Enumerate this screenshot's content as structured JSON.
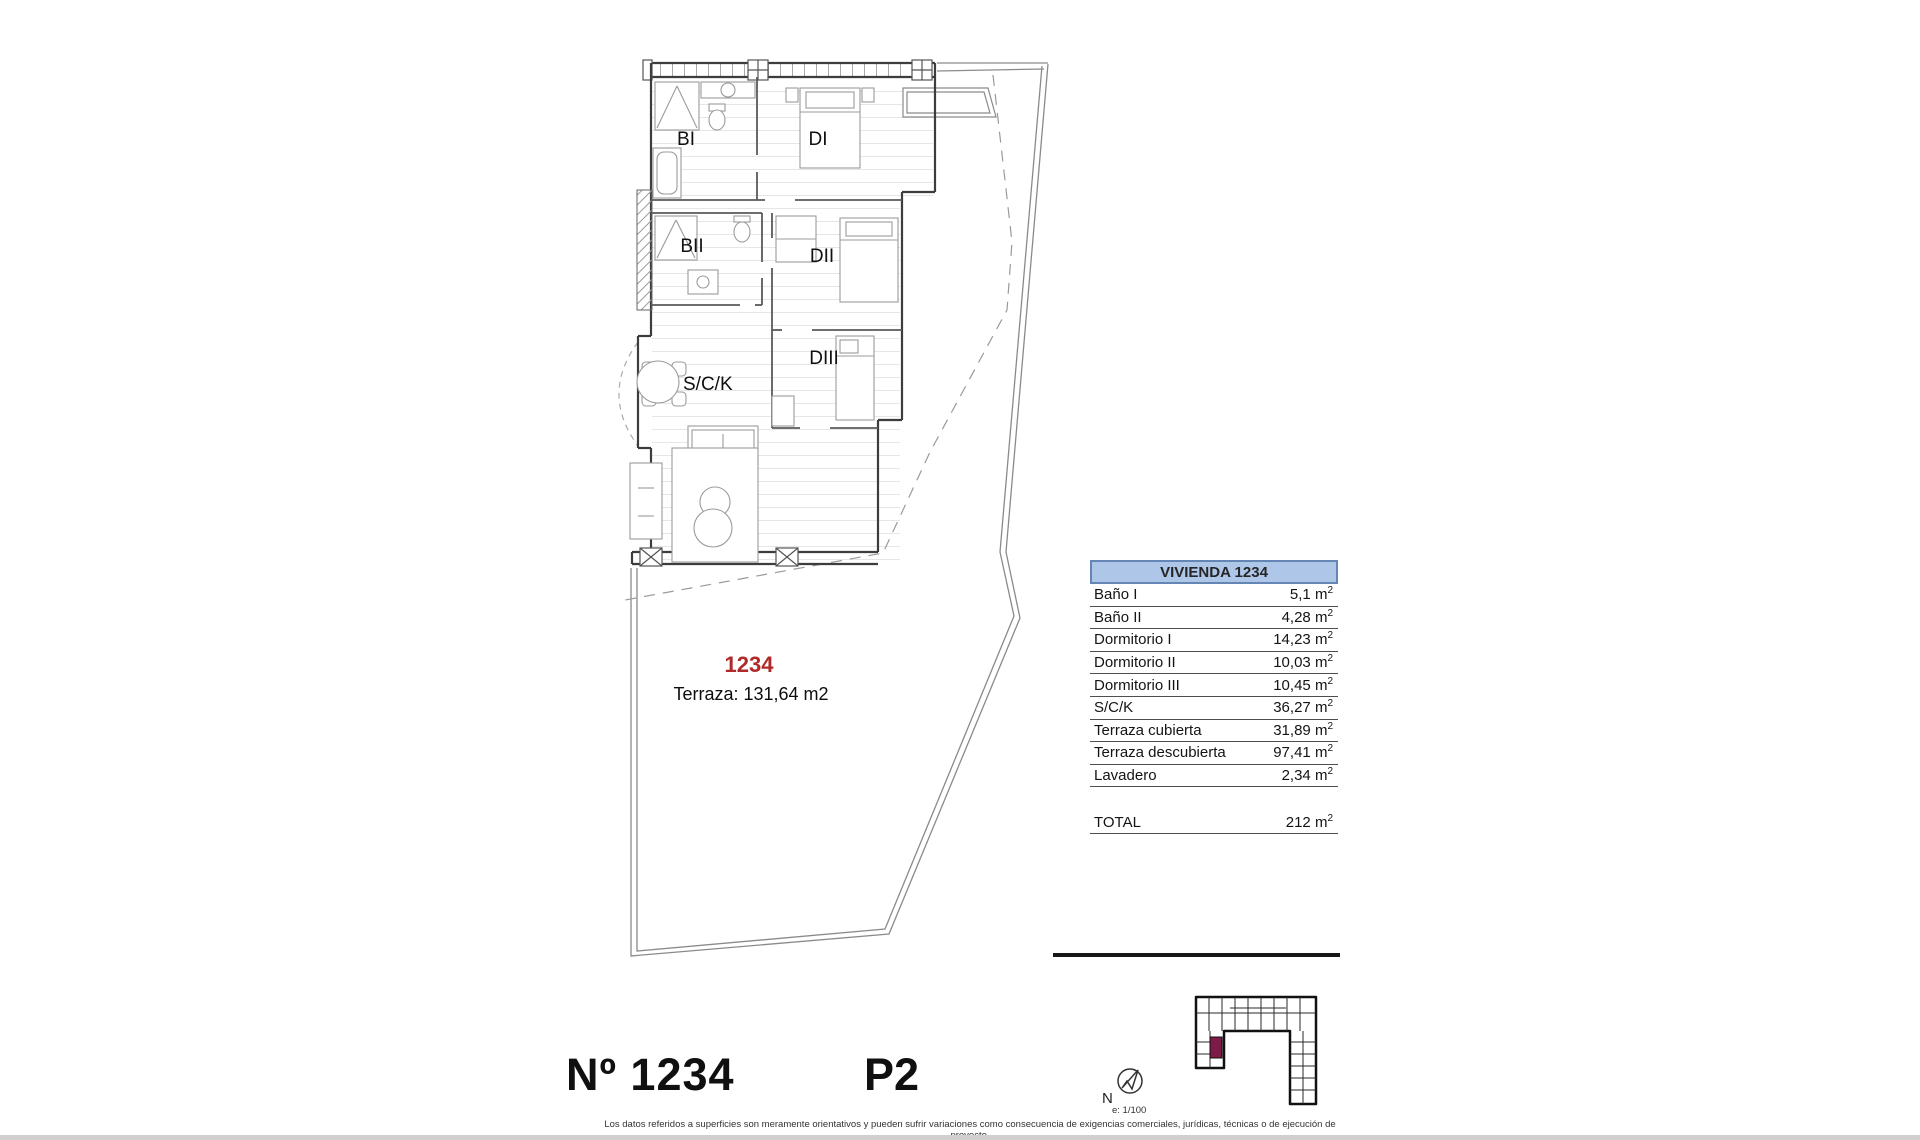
{
  "plan": {
    "room_labels": {
      "bi": "BI",
      "di": "DI",
      "bii": "BII",
      "dii": "DII",
      "diii": "DIII",
      "sck": "S/C/K"
    },
    "unit_number": "1234",
    "terrace_note": "Terraza: 131,64 m2",
    "colors": {
      "unit_number_red": "#b02a2a",
      "keyplan_highlight": "#7d1a45",
      "table_header_bg": "#aec6e8"
    }
  },
  "area_table": {
    "title": "VIVIENDA 1234",
    "rows": [
      {
        "label": "Baño I",
        "value": "5,1",
        "unit": "m",
        "exp": "2"
      },
      {
        "label": "Baño II",
        "value": "4,28",
        "unit": "m",
        "exp": "2"
      },
      {
        "label": "Dormitorio I",
        "value": "14,23",
        "unit": "m",
        "exp": "2"
      },
      {
        "label": "Dormitorio II",
        "value": "10,03",
        "unit": "m",
        "exp": "2"
      },
      {
        "label": "Dormitorio III",
        "value": "10,45",
        "unit": "m",
        "exp": "2"
      },
      {
        "label": "S/C/K",
        "value": "36,27",
        "unit": "m",
        "exp": "2"
      },
      {
        "label": "Terraza cubierta",
        "value": "31,89",
        "unit": "m",
        "exp": "2"
      },
      {
        "label": "Terraza descubierta",
        "value": "97,41",
        "unit": "m",
        "exp": "2"
      },
      {
        "label": "Lavadero",
        "value": "2,34",
        "unit": "m",
        "exp": "2"
      }
    ],
    "total": {
      "label": "TOTAL",
      "value": "212",
      "unit": "m",
      "exp": "2"
    }
  },
  "compass": {
    "north_label": "N",
    "scale_label": "e: 1/100"
  },
  "footer": {
    "unit_title": "Nº 1234",
    "floor": "P2",
    "disclaimer": "Los datos referidos a superficies son meramente orientativos y pueden sufrir variaciones como consecuencia de exigencias comerciales, jurídicas, técnicas o de ejecución de proyecto."
  }
}
